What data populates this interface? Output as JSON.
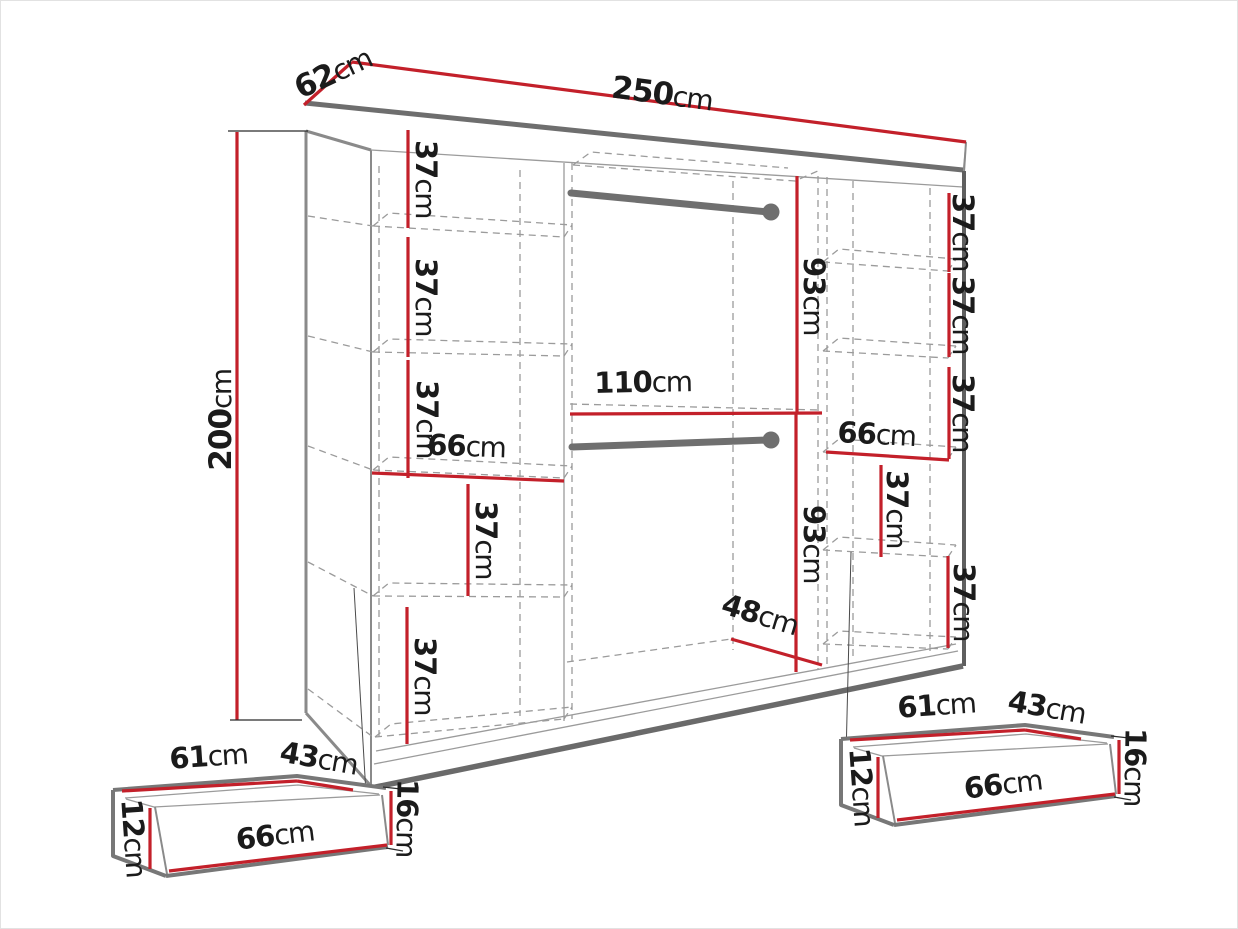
{
  "colors": {
    "dimension_line": "#c3202a",
    "outline_gray": "#6e6e6e",
    "hidden_line_gray": "#9b9b9b",
    "text": "#1b1b1b",
    "background": "#ffffff"
  },
  "wardrobe": {
    "overall": {
      "width": {
        "v": "250",
        "u": "cm"
      },
      "depth": {
        "v": "62",
        "u": "cm"
      },
      "height": {
        "v": "200",
        "u": "cm"
      }
    },
    "left_column": {
      "section_1": {
        "v": "37",
        "u": "cm"
      },
      "section_2": {
        "v": "37",
        "u": "cm"
      },
      "section_3": {
        "v": "37",
        "u": "cm"
      },
      "shelf_width": {
        "v": "66",
        "u": "cm"
      },
      "section_4": {
        "v": "37",
        "u": "cm"
      },
      "section_5": {
        "v": "37",
        "u": "cm"
      }
    },
    "middle_section": {
      "upper_height": {
        "v": "93",
        "u": "cm"
      },
      "width": {
        "v": "110",
        "u": "cm"
      },
      "lower_height": {
        "v": "93",
        "u": "cm"
      },
      "bottom_width": {
        "v": "48",
        "u": "cm"
      }
    },
    "right_column": {
      "section_1": {
        "v": "37",
        "u": "cm"
      },
      "section_2": {
        "v": "37",
        "u": "cm"
      },
      "section_3": {
        "v": "37",
        "u": "cm"
      },
      "shelf_width": {
        "v": "66",
        "u": "cm"
      },
      "section_4": {
        "v": "37",
        "u": "cm"
      },
      "section_5": {
        "v": "37",
        "u": "cm"
      }
    }
  },
  "drawers": [
    {
      "top_width": {
        "v": "61",
        "u": "cm"
      },
      "top_depth": {
        "v": "43",
        "u": "cm"
      },
      "side_height": {
        "v": "12",
        "u": "cm"
      },
      "front_height": {
        "v": "16",
        "u": "cm"
      },
      "front_width": {
        "v": "66",
        "u": "cm"
      }
    },
    {
      "top_width": {
        "v": "61",
        "u": "cm"
      },
      "top_depth": {
        "v": "43",
        "u": "cm"
      },
      "side_height": {
        "v": "12",
        "u": "cm"
      },
      "front_height": {
        "v": "16",
        "u": "cm"
      },
      "front_width": {
        "v": "66",
        "u": "cm"
      }
    }
  ]
}
